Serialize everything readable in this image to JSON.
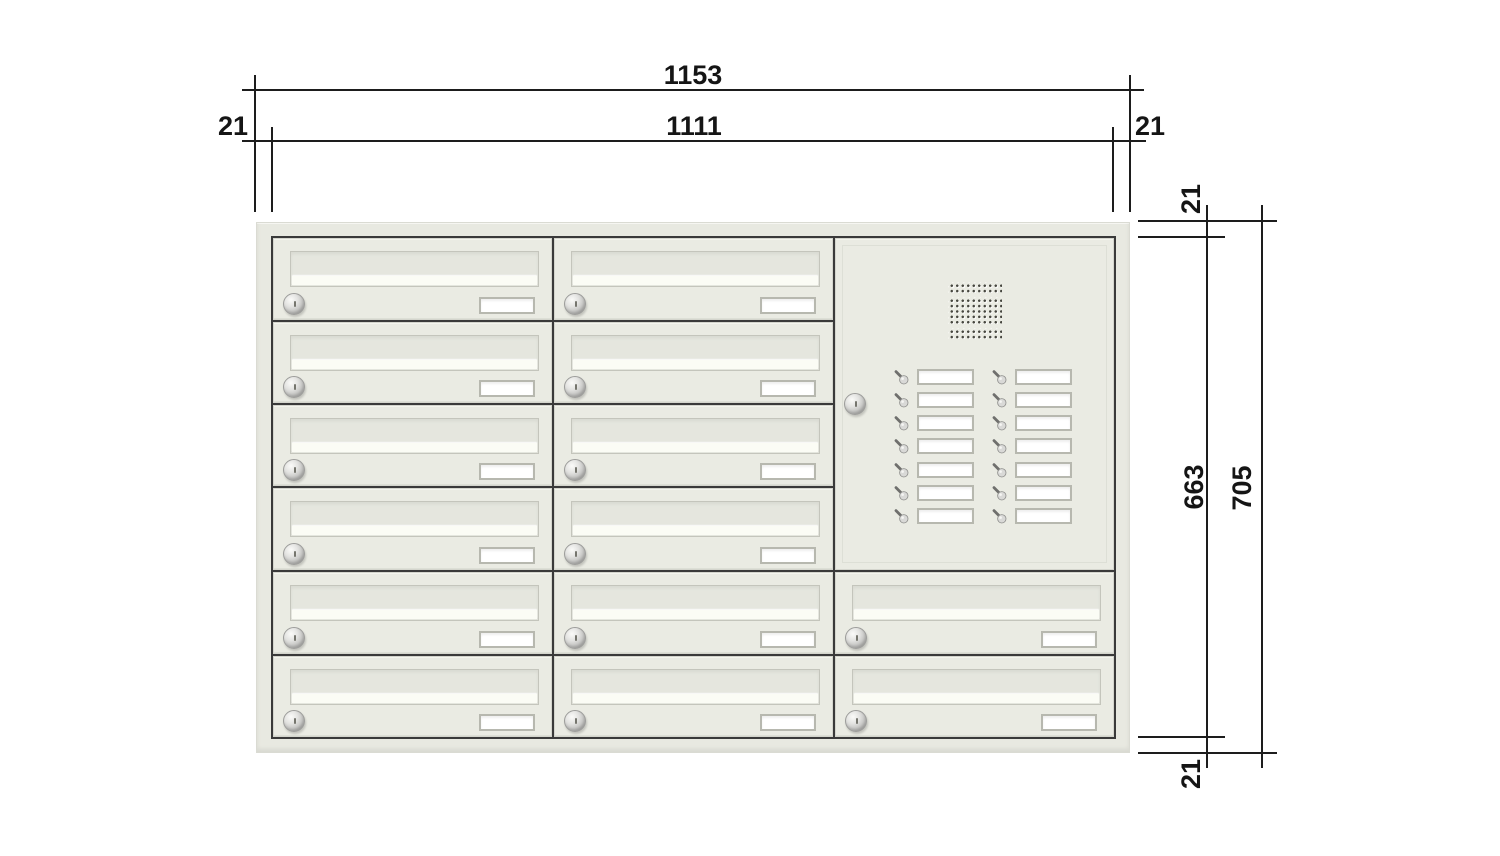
{
  "drawing": {
    "dims": {
      "overall_width": "1153",
      "inner_width": "1111",
      "margin_left": "21",
      "margin_right": "21",
      "margin_top": "21",
      "margin_bottom": "21",
      "inner_height": "663",
      "overall_height": "705"
    },
    "cabinet": {
      "columns": 3,
      "rows": 6,
      "mailbox_count": 14,
      "intercom": {
        "speaker": "dot-grille",
        "bell_rows": 7,
        "bell_columns": 2,
        "bell_count": 14
      }
    },
    "colors": {
      "panel": "#e8e9e1",
      "door": "#eaebe3",
      "frame_line": "#3a3a3a",
      "dimension_line": "#1d1d1d",
      "plate_frame": "#b7b8af"
    }
  }
}
